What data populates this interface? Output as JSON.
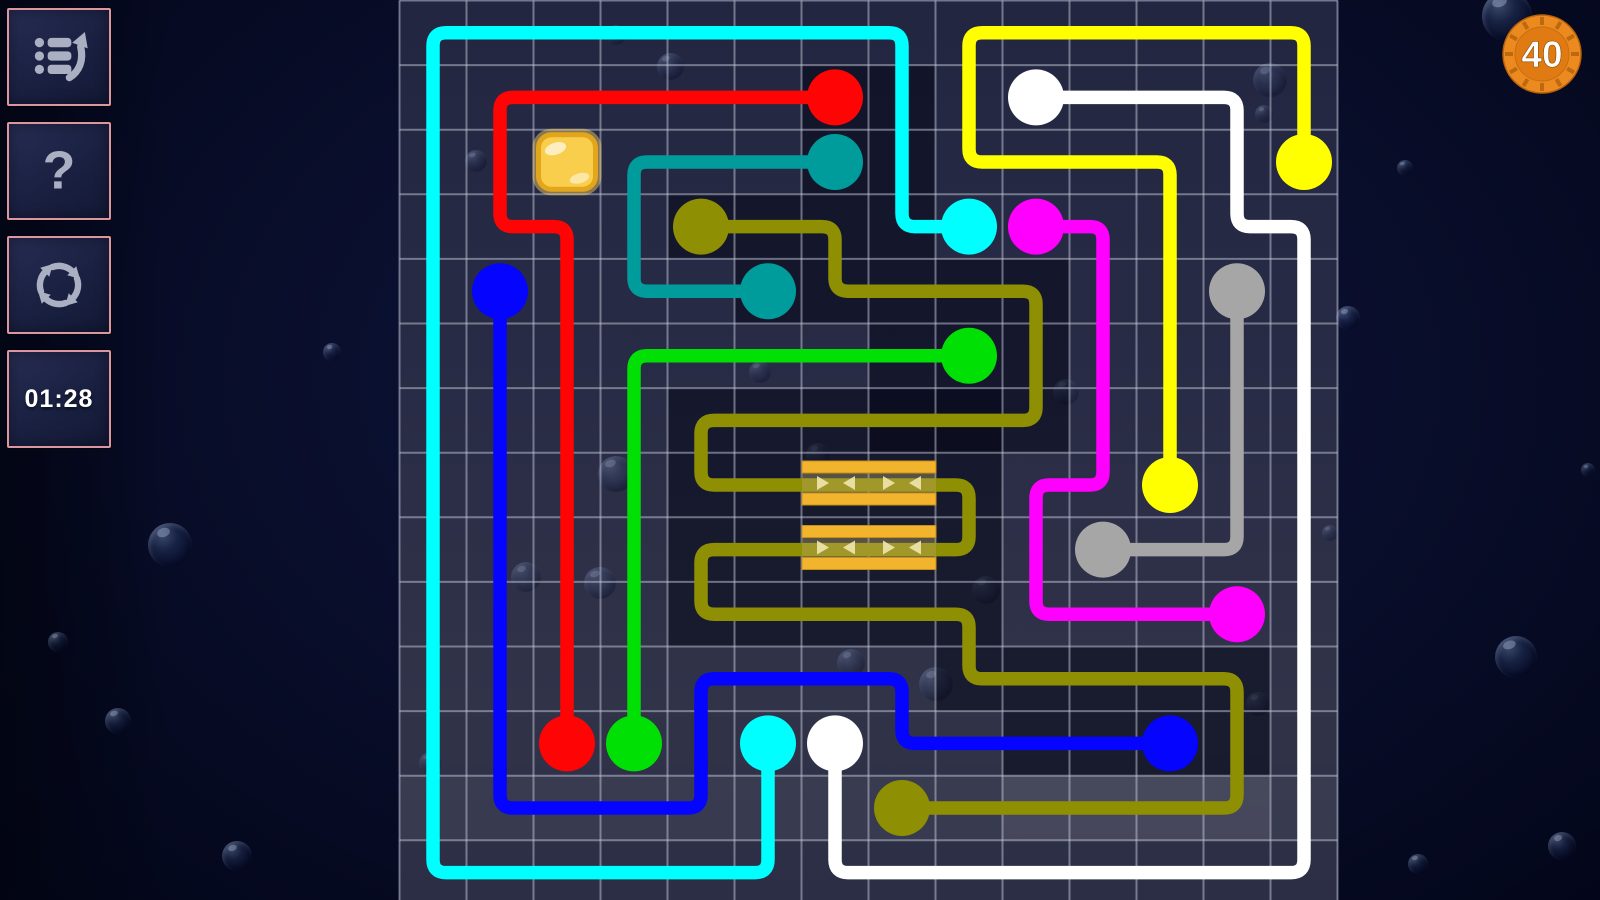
{
  "sidebar": {
    "buttons": [
      {
        "id": "menu",
        "icon": "list-arrow-icon"
      },
      {
        "id": "help",
        "icon": "question-icon"
      },
      {
        "id": "restart",
        "icon": "refresh-icon"
      },
      {
        "id": "timer",
        "icon": "none"
      }
    ],
    "timer_label": "01:28"
  },
  "hud": {
    "badge_value": "40"
  },
  "colors": {
    "board_grid": "rgba(195,200,215,0.5)",
    "dark_patch": "rgba(1,4,20,0.5)",
    "stripe_bar": "#F2B42D",
    "stripe_band": "rgba(186,168,100,0.40)",
    "stripe_arrow": "rgba(240,230,175,0.9)",
    "tile_fill": "#F9CE4D",
    "tile_border": "#E2A51C",
    "badge_orange": "#EC8A20"
  },
  "board": {
    "geometry": {
      "left": 399.5,
      "top": 0.5,
      "cols": 14,
      "rows": 14,
      "cell_w": 67,
      "cell_h": 64.6
    },
    "line_width": 13.5,
    "corner_radius": 13,
    "dot_radius": 28,
    "patches": [
      {
        "c": 7,
        "r": 2,
        "w": 2,
        "h": 2
      },
      {
        "c": 5,
        "r": 4,
        "w": 3,
        "h": 1
      },
      {
        "c": 8,
        "r": 4,
        "w": 1,
        "h": 1
      },
      {
        "c": 6,
        "r": 5,
        "w": 2,
        "h": 1
      },
      {
        "c": 8,
        "r": 5,
        "w": 3,
        "h": 3
      },
      {
        "c": 5,
        "r": 7,
        "w": 4,
        "h": 4
      },
      {
        "c": 9,
        "r": 7,
        "w": 1,
        "h": 5
      },
      {
        "c": 10,
        "r": 11,
        "w": 4,
        "h": 2
      }
    ],
    "light_bands": [
      {
        "c": 1,
        "r": 13,
        "w": 14,
        "h": 1,
        "o": 0.05
      },
      {
        "c": 10,
        "r": 13,
        "w": 4,
        "h": 1,
        "o": 0.07
      }
    ],
    "bonus_tile": {
      "c": 3,
      "r": 3
    },
    "stripes": {
      "x": 802,
      "w": 134,
      "bar_h": 12,
      "band_h": 20,
      "groups": [
        {
          "bars_y": [
            461,
            493
          ],
          "band_y": 473
        },
        {
          "bars_y": [
            525.5,
            557.5
          ],
          "band_y": 537.5
        }
      ],
      "arrows_x": [
        822,
        850,
        888,
        916
      ],
      "arrow_dirs": [
        "r",
        "l",
        "r",
        "l"
      ]
    },
    "flows": [
      {
        "name": "cyan",
        "hex": "#00FFFF",
        "points": [
          [
            6,
            12
          ],
          [
            6,
            14
          ],
          [
            1,
            14
          ],
          [
            1,
            1
          ],
          [
            8,
            1
          ],
          [
            8,
            4
          ],
          [
            9,
            4
          ]
        ]
      },
      {
        "name": "red",
        "hex": "#FF0404",
        "points": [
          [
            7,
            2
          ],
          [
            2,
            2
          ],
          [
            2,
            4
          ],
          [
            3,
            4
          ],
          [
            3,
            12
          ]
        ]
      },
      {
        "name": "teal",
        "hex": "#009C9C",
        "points": [
          [
            7,
            3
          ],
          [
            4,
            3
          ],
          [
            4,
            5
          ],
          [
            6,
            5
          ]
        ]
      },
      {
        "name": "olive",
        "hex": "#8F8F04",
        "points": [
          [
            5,
            4
          ],
          [
            7,
            4
          ],
          [
            7,
            5
          ],
          [
            10,
            5
          ],
          [
            10,
            7
          ],
          [
            5,
            7
          ],
          [
            5,
            8
          ],
          [
            9,
            8
          ],
          [
            9,
            9
          ],
          [
            5,
            9
          ],
          [
            5,
            10
          ],
          [
            9,
            10
          ],
          [
            9,
            11
          ],
          [
            13,
            11
          ],
          [
            13,
            13
          ],
          [
            8,
            13
          ]
        ]
      },
      {
        "name": "blue",
        "hex": "#0404FF",
        "points": [
          [
            2,
            5
          ],
          [
            2,
            13
          ],
          [
            5,
            13
          ],
          [
            5,
            11
          ],
          [
            8,
            11
          ],
          [
            8,
            12
          ],
          [
            12,
            12
          ]
        ]
      },
      {
        "name": "green",
        "hex": "#00E004",
        "points": [
          [
            9,
            6
          ],
          [
            4,
            6
          ],
          [
            4,
            12
          ]
        ]
      },
      {
        "name": "yellow",
        "hex": "#FFFF00",
        "points": [
          [
            14,
            3
          ],
          [
            14,
            1
          ],
          [
            9,
            1
          ],
          [
            9,
            3
          ],
          [
            12,
            3
          ],
          [
            12,
            8
          ]
        ]
      },
      {
        "name": "white",
        "hex": "#FFFFFF",
        "points": [
          [
            10,
            2
          ],
          [
            13,
            2
          ],
          [
            13,
            4
          ],
          [
            14,
            4
          ],
          [
            14,
            14
          ],
          [
            7,
            14
          ],
          [
            7,
            12
          ]
        ]
      },
      {
        "name": "magenta",
        "hex": "#FF00FF",
        "points": [
          [
            10,
            4
          ],
          [
            11,
            4
          ],
          [
            11,
            8
          ],
          [
            10,
            8
          ],
          [
            10,
            10
          ],
          [
            13,
            10
          ]
        ]
      },
      {
        "name": "gray",
        "hex": "#A6A6A6",
        "points": [
          [
            13,
            5
          ],
          [
            13,
            9
          ],
          [
            11,
            9
          ]
        ]
      }
    ]
  },
  "bubbles": {
    "wallpaper": [
      {
        "x": 1507,
        "y": 16,
        "d": 50,
        "o": 0.95
      },
      {
        "x": 170,
        "y": 545,
        "d": 44,
        "o": 0.9
      },
      {
        "x": 118,
        "y": 721,
        "d": 26,
        "o": 0.85
      },
      {
        "x": 332,
        "y": 352,
        "d": 18,
        "o": 0.8
      },
      {
        "x": 237,
        "y": 856,
        "d": 30,
        "o": 0.85
      },
      {
        "x": 1348,
        "y": 318,
        "d": 24,
        "o": 0.85
      },
      {
        "x": 1516,
        "y": 657,
        "d": 42,
        "o": 0.9
      },
      {
        "x": 1562,
        "y": 846,
        "d": 28,
        "o": 0.85
      },
      {
        "x": 1418,
        "y": 864,
        "d": 20,
        "o": 0.8
      },
      {
        "x": 58,
        "y": 642,
        "d": 20,
        "o": 0.75
      },
      {
        "x": 1405,
        "y": 168,
        "d": 16,
        "o": 0.75
      },
      {
        "x": 1588,
        "y": 470,
        "d": 14,
        "o": 0.7
      }
    ],
    "board": [
      {
        "x": 670,
        "y": 66,
        "d": 27,
        "o": 0.55
      },
      {
        "x": 616,
        "y": 35,
        "d": 20,
        "o": 0.5
      },
      {
        "x": 476,
        "y": 161,
        "d": 22,
        "o": 0.55
      },
      {
        "x": 616,
        "y": 474,
        "d": 36,
        "o": 0.6
      },
      {
        "x": 600,
        "y": 583,
        "d": 32,
        "o": 0.55
      },
      {
        "x": 526,
        "y": 577,
        "d": 30,
        "o": 0.5
      },
      {
        "x": 851,
        "y": 663,
        "d": 28,
        "o": 0.5
      },
      {
        "x": 936,
        "y": 684,
        "d": 34,
        "o": 0.55
      },
      {
        "x": 1270,
        "y": 80,
        "d": 34,
        "o": 0.55
      },
      {
        "x": 1264,
        "y": 114,
        "d": 18,
        "o": 0.5
      },
      {
        "x": 1066,
        "y": 392,
        "d": 26,
        "o": 0.5
      },
      {
        "x": 986,
        "y": 590,
        "d": 28,
        "o": 0.5
      },
      {
        "x": 760,
        "y": 372,
        "d": 22,
        "o": 0.45
      },
      {
        "x": 1258,
        "y": 704,
        "d": 24,
        "o": 0.5
      },
      {
        "x": 818,
        "y": 455,
        "d": 24,
        "o": 0.45
      },
      {
        "x": 1330,
        "y": 533,
        "d": 16,
        "o": 0.45
      },
      {
        "x": 430,
        "y": 763,
        "d": 22,
        "o": 0.4
      }
    ]
  }
}
